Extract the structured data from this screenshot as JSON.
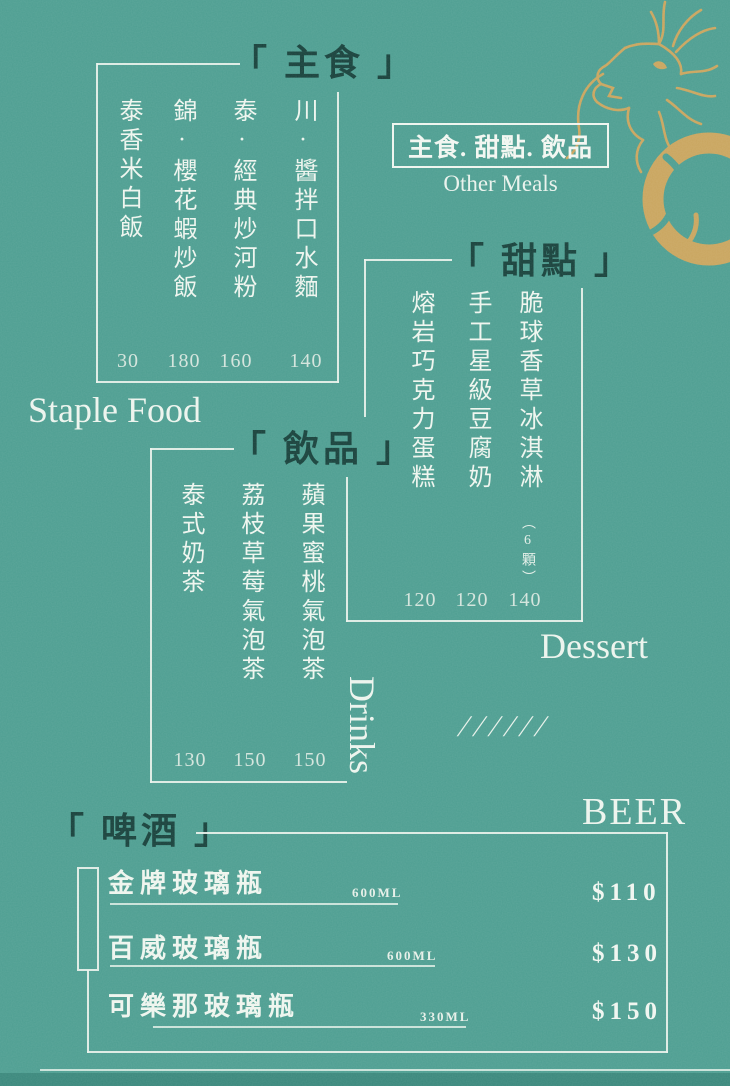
{
  "colors": {
    "background": "#4d9e91",
    "accent_dark": "#17413b",
    "text_light": "#eef5ee",
    "gold": "#c9a55e",
    "footer_band": "#3a887c"
  },
  "header": {
    "title": "主食. 甜點. 飲品",
    "subtitle": "Other Meals"
  },
  "sections": {
    "staple": {
      "title": "「 主食 」",
      "en_label": "Staple Food",
      "items": [
        {
          "name": "泰香米白飯",
          "price": "30"
        },
        {
          "name": "錦·櫻花蝦炒飯",
          "price": "180"
        },
        {
          "name": "泰·經典炒河粉",
          "price": "160"
        },
        {
          "name": "川·醬拌口水麵",
          "price": "140"
        }
      ]
    },
    "dessert": {
      "title": "「 甜點 」",
      "en_label": "Dessert",
      "slashes": "//////",
      "items": [
        {
          "name": "熔岩巧克力蛋糕",
          "price": "120"
        },
        {
          "name": "手工星級豆腐奶",
          "price": "120"
        },
        {
          "name": "脆球香草冰淇淋",
          "note": "（6顆）",
          "price": "140"
        }
      ]
    },
    "drinks": {
      "title": "「 飲品 」",
      "en_label": "Drinks",
      "items": [
        {
          "name": "泰式奶茶",
          "price": "130"
        },
        {
          "name": "荔枝草莓氣泡茶",
          "price": "150"
        },
        {
          "name": "蘋果蜜桃氣泡茶",
          "price": "150"
        }
      ]
    },
    "beer": {
      "title": "「 啤酒 」",
      "en_label": "BEER",
      "items": [
        {
          "name": "金牌玻璃瓶",
          "size": "600ML",
          "price": "$110"
        },
        {
          "name": "百威玻璃瓶",
          "size": "600ML",
          "price": "$130"
        },
        {
          "name": "可樂那玻璃瓶",
          "size": "330ML",
          "price": "$150"
        }
      ]
    }
  },
  "decor": {
    "dragon_icon": "gold-dragon",
    "ring_icon": "gold-ring"
  }
}
